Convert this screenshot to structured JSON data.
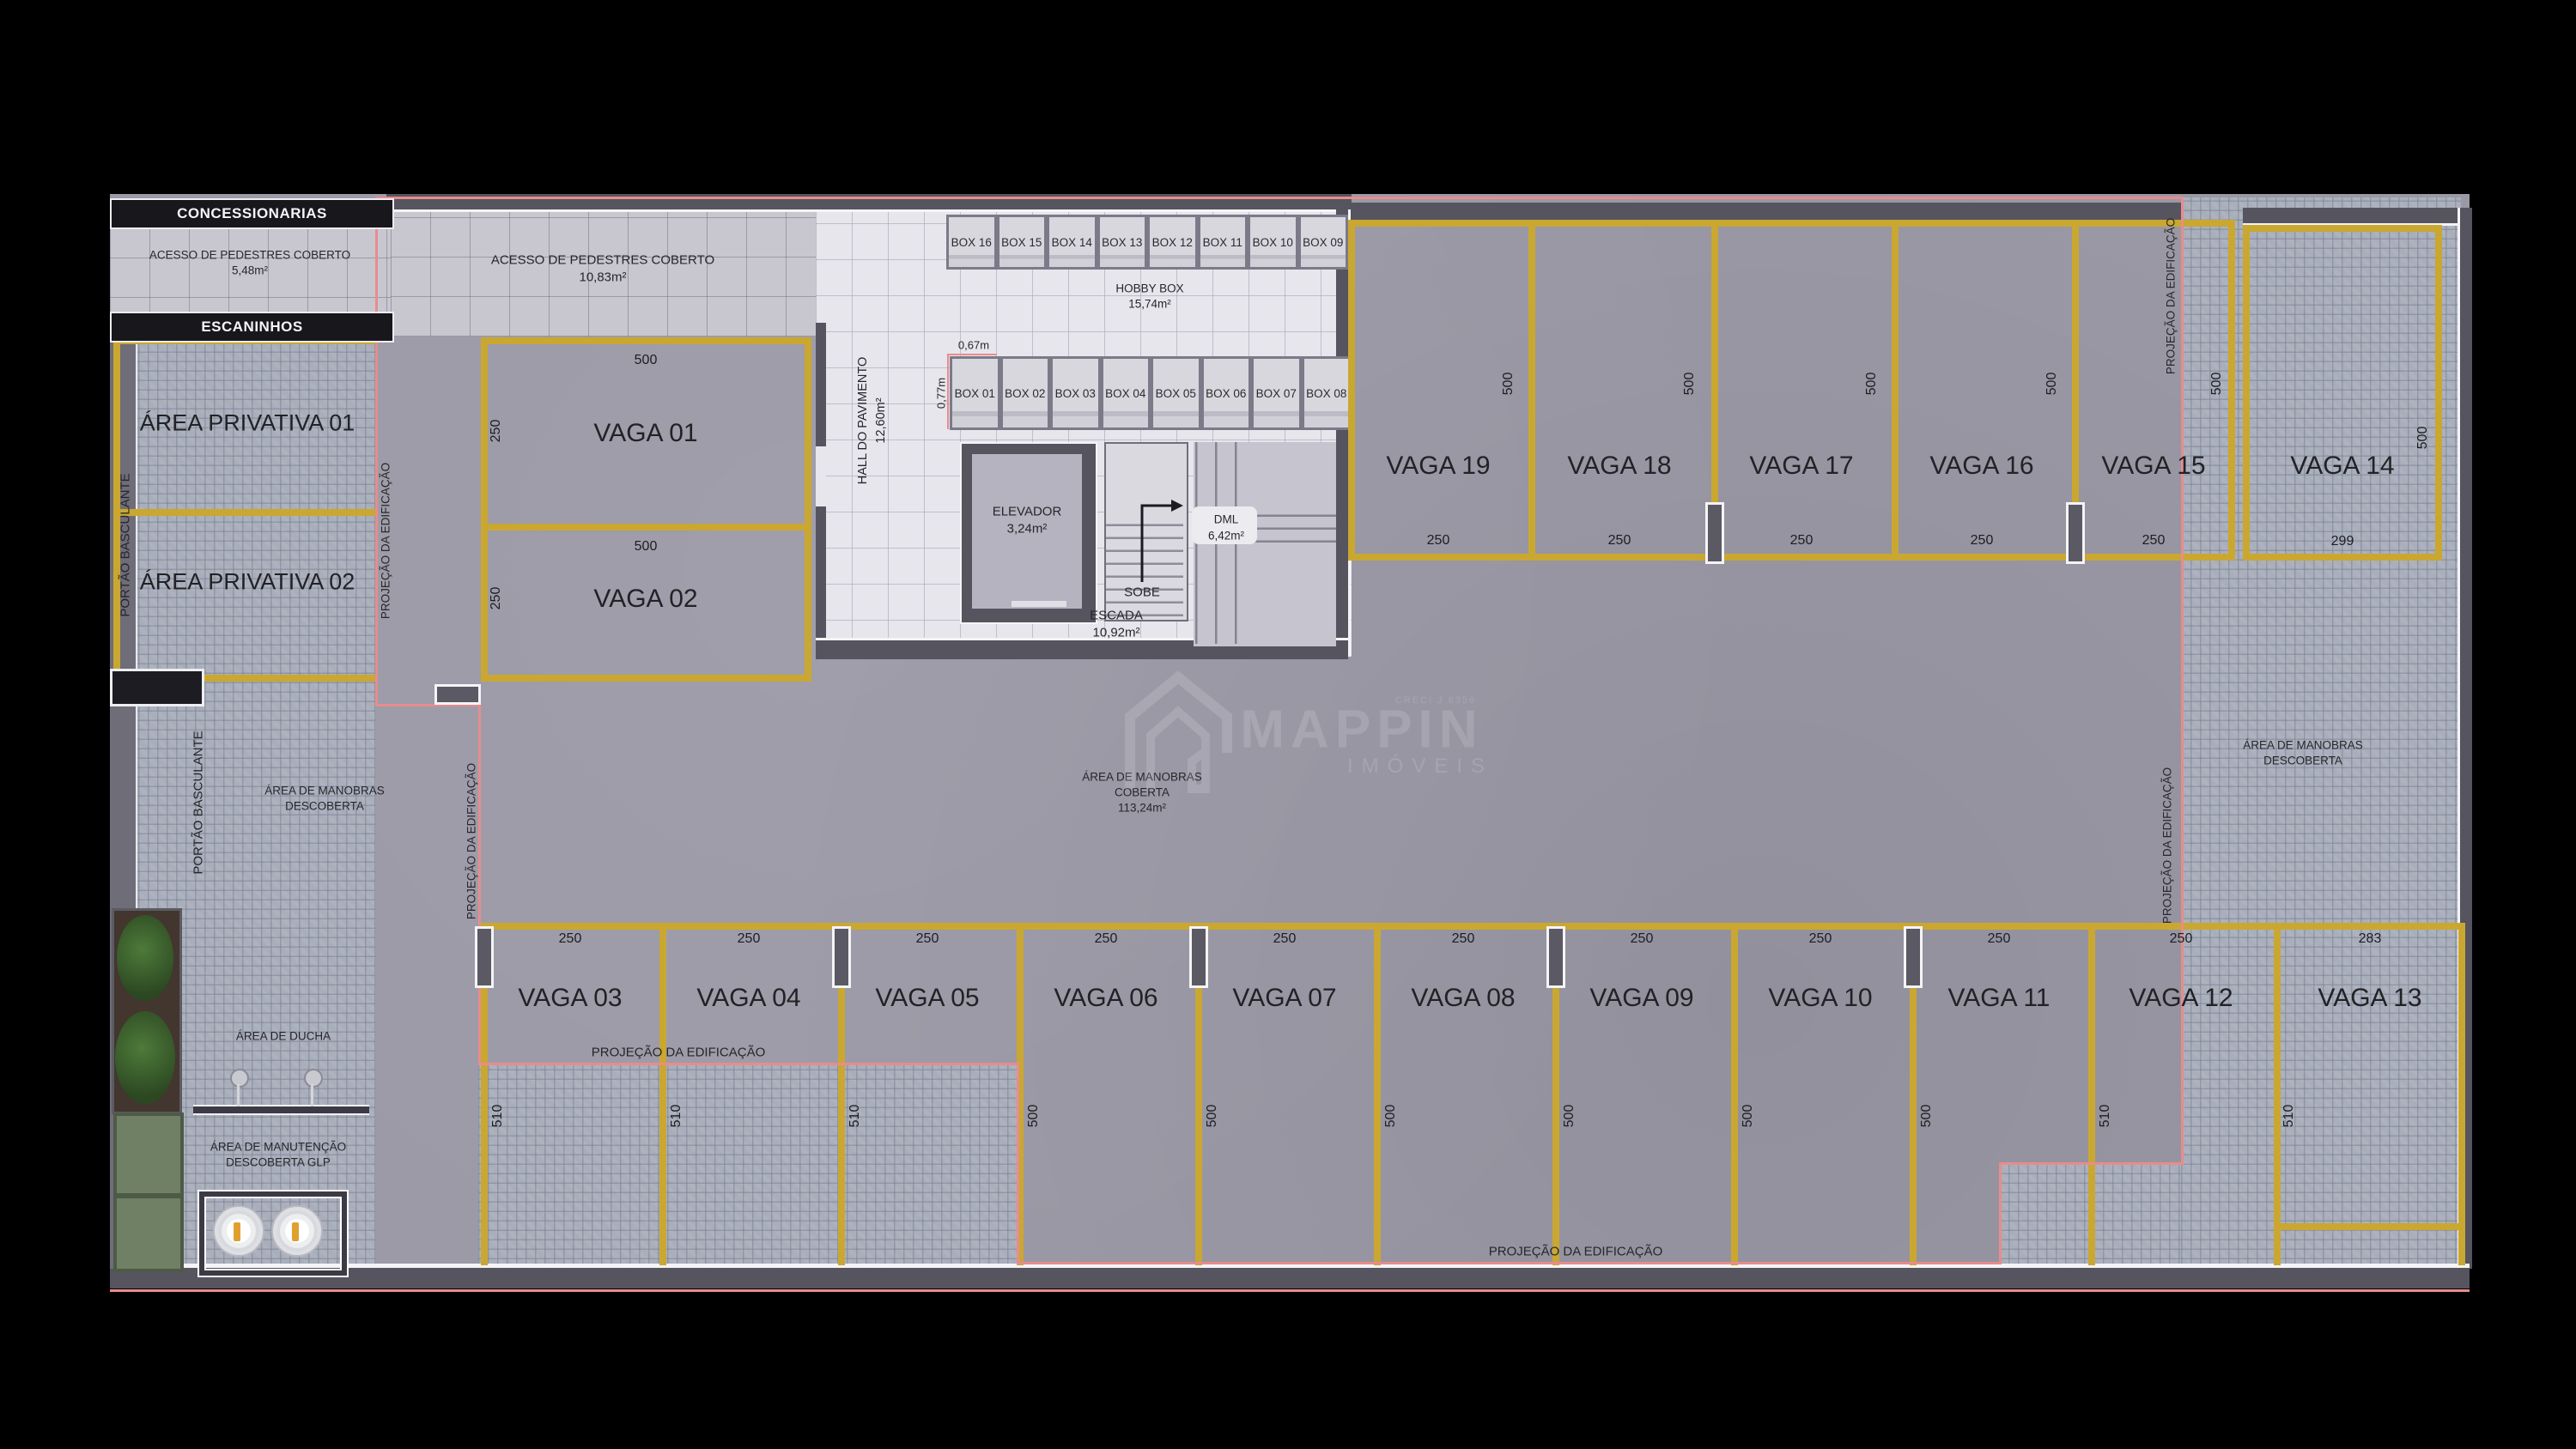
{
  "banners": {
    "concessionarias": "CONCESSIONARIAS",
    "escaninhos": "ESCANINHOS"
  },
  "labels": {
    "acesso1_l1": "ACESSO DE PEDESTRES COBERTO",
    "acesso1_l2": "5,48m²",
    "acesso2_l1": "ACESSO DE PEDESTRES COBERTO",
    "acesso2_l2": "10,83m²",
    "priv1": "ÁREA PRIVATIVA 01",
    "priv2": "ÁREA PRIVATIVA 02",
    "hall_l1": "HALL DO PAVIMENTO",
    "hall_l2": "12,60m²",
    "hobby_l1": "HOBBY BOX",
    "hobby_l2": "15,74m²",
    "elev_l1": "ELEVADOR",
    "elev_l2": "3,24m²",
    "sobe": "SOBE",
    "dml_l1": "DML",
    "dml_l2": "6,42m²",
    "escada_l1": "ESCADA",
    "escada_l2": "10,92m²",
    "manobras_cob_l1": "ÁREA DE MANOBRAS",
    "manobras_cob_l2": "COBERTA",
    "manobras_cob_l3": "113,24m²",
    "manobras_desc_l1": "ÁREA DE MANOBRAS",
    "manobras_desc_l2": "DESCOBERTA",
    "ducha": "ÁREA DE DUCHA",
    "manut_l1": "ÁREA DE MANUTENÇÃO",
    "manut_l2": "DESCOBERTA GLP",
    "portao": "PORTÃO BASCULANTE",
    "projecao": "PROJEÇÃO DA EDIFICAÇÃO",
    "dim_067": "0,67m",
    "dim_077": "0,77m"
  },
  "boxes_top": [
    "BOX 16",
    "BOX 15",
    "BOX 14",
    "BOX 13",
    "BOX 12",
    "BOX 11",
    "BOX 10",
    "BOX 09"
  ],
  "boxes_bottom": [
    "BOX 01",
    "BOX 02",
    "BOX 03",
    "BOX 04",
    "BOX 05",
    "BOX 06",
    "BOX 07",
    "BOX 08"
  ],
  "vaga_block": {
    "v1": "VAGA 01",
    "v1_w": "500",
    "v1_d": "250",
    "v2": "VAGA 02",
    "v2_w": "500",
    "v2_d": "250"
  },
  "vagas_top": [
    {
      "label": "VAGA 19",
      "depth": "500",
      "width": "250"
    },
    {
      "label": "VAGA 18",
      "depth": "500",
      "width": "250"
    },
    {
      "label": "VAGA 17",
      "depth": "500",
      "width": "250"
    },
    {
      "label": "VAGA 16",
      "depth": "500",
      "width": "250"
    },
    {
      "label": "VAGA 15",
      "depth": "500",
      "width": "250"
    },
    {
      "label": "VAGA 14",
      "depth": "500",
      "width": "299"
    }
  ],
  "vagas_bottom": [
    {
      "label": "VAGA 03",
      "width": "250",
      "depth": "510"
    },
    {
      "label": "VAGA 04",
      "width": "250",
      "depth": "510"
    },
    {
      "label": "VAGA 05",
      "width": "250",
      "depth": "510"
    },
    {
      "label": "VAGA 06",
      "width": "250",
      "depth": "500"
    },
    {
      "label": "VAGA 07",
      "width": "250",
      "depth": "500"
    },
    {
      "label": "VAGA 08",
      "width": "250",
      "depth": "500"
    },
    {
      "label": "VAGA 09",
      "width": "250",
      "depth": "500"
    },
    {
      "label": "VAGA 10",
      "width": "250",
      "depth": "500"
    },
    {
      "label": "VAGA 11",
      "width": "250",
      "depth": "500"
    },
    {
      "label": "VAGA 12",
      "width": "250",
      "depth": "510"
    },
    {
      "label": "VAGA 13",
      "width": "283",
      "depth": "510"
    }
  ],
  "watermark": {
    "creci": "CRECI J 8356",
    "brand": "MAPPIN",
    "subtitle": "IMÓVEIS"
  },
  "colors": {
    "concrete": "#9b99a6",
    "paver": "#a9aebb",
    "tile": "#e7e6ec",
    "yellow": "#caa730",
    "red_line": "#e88c8c",
    "wall": "#55545f",
    "banner": "#17171c"
  }
}
